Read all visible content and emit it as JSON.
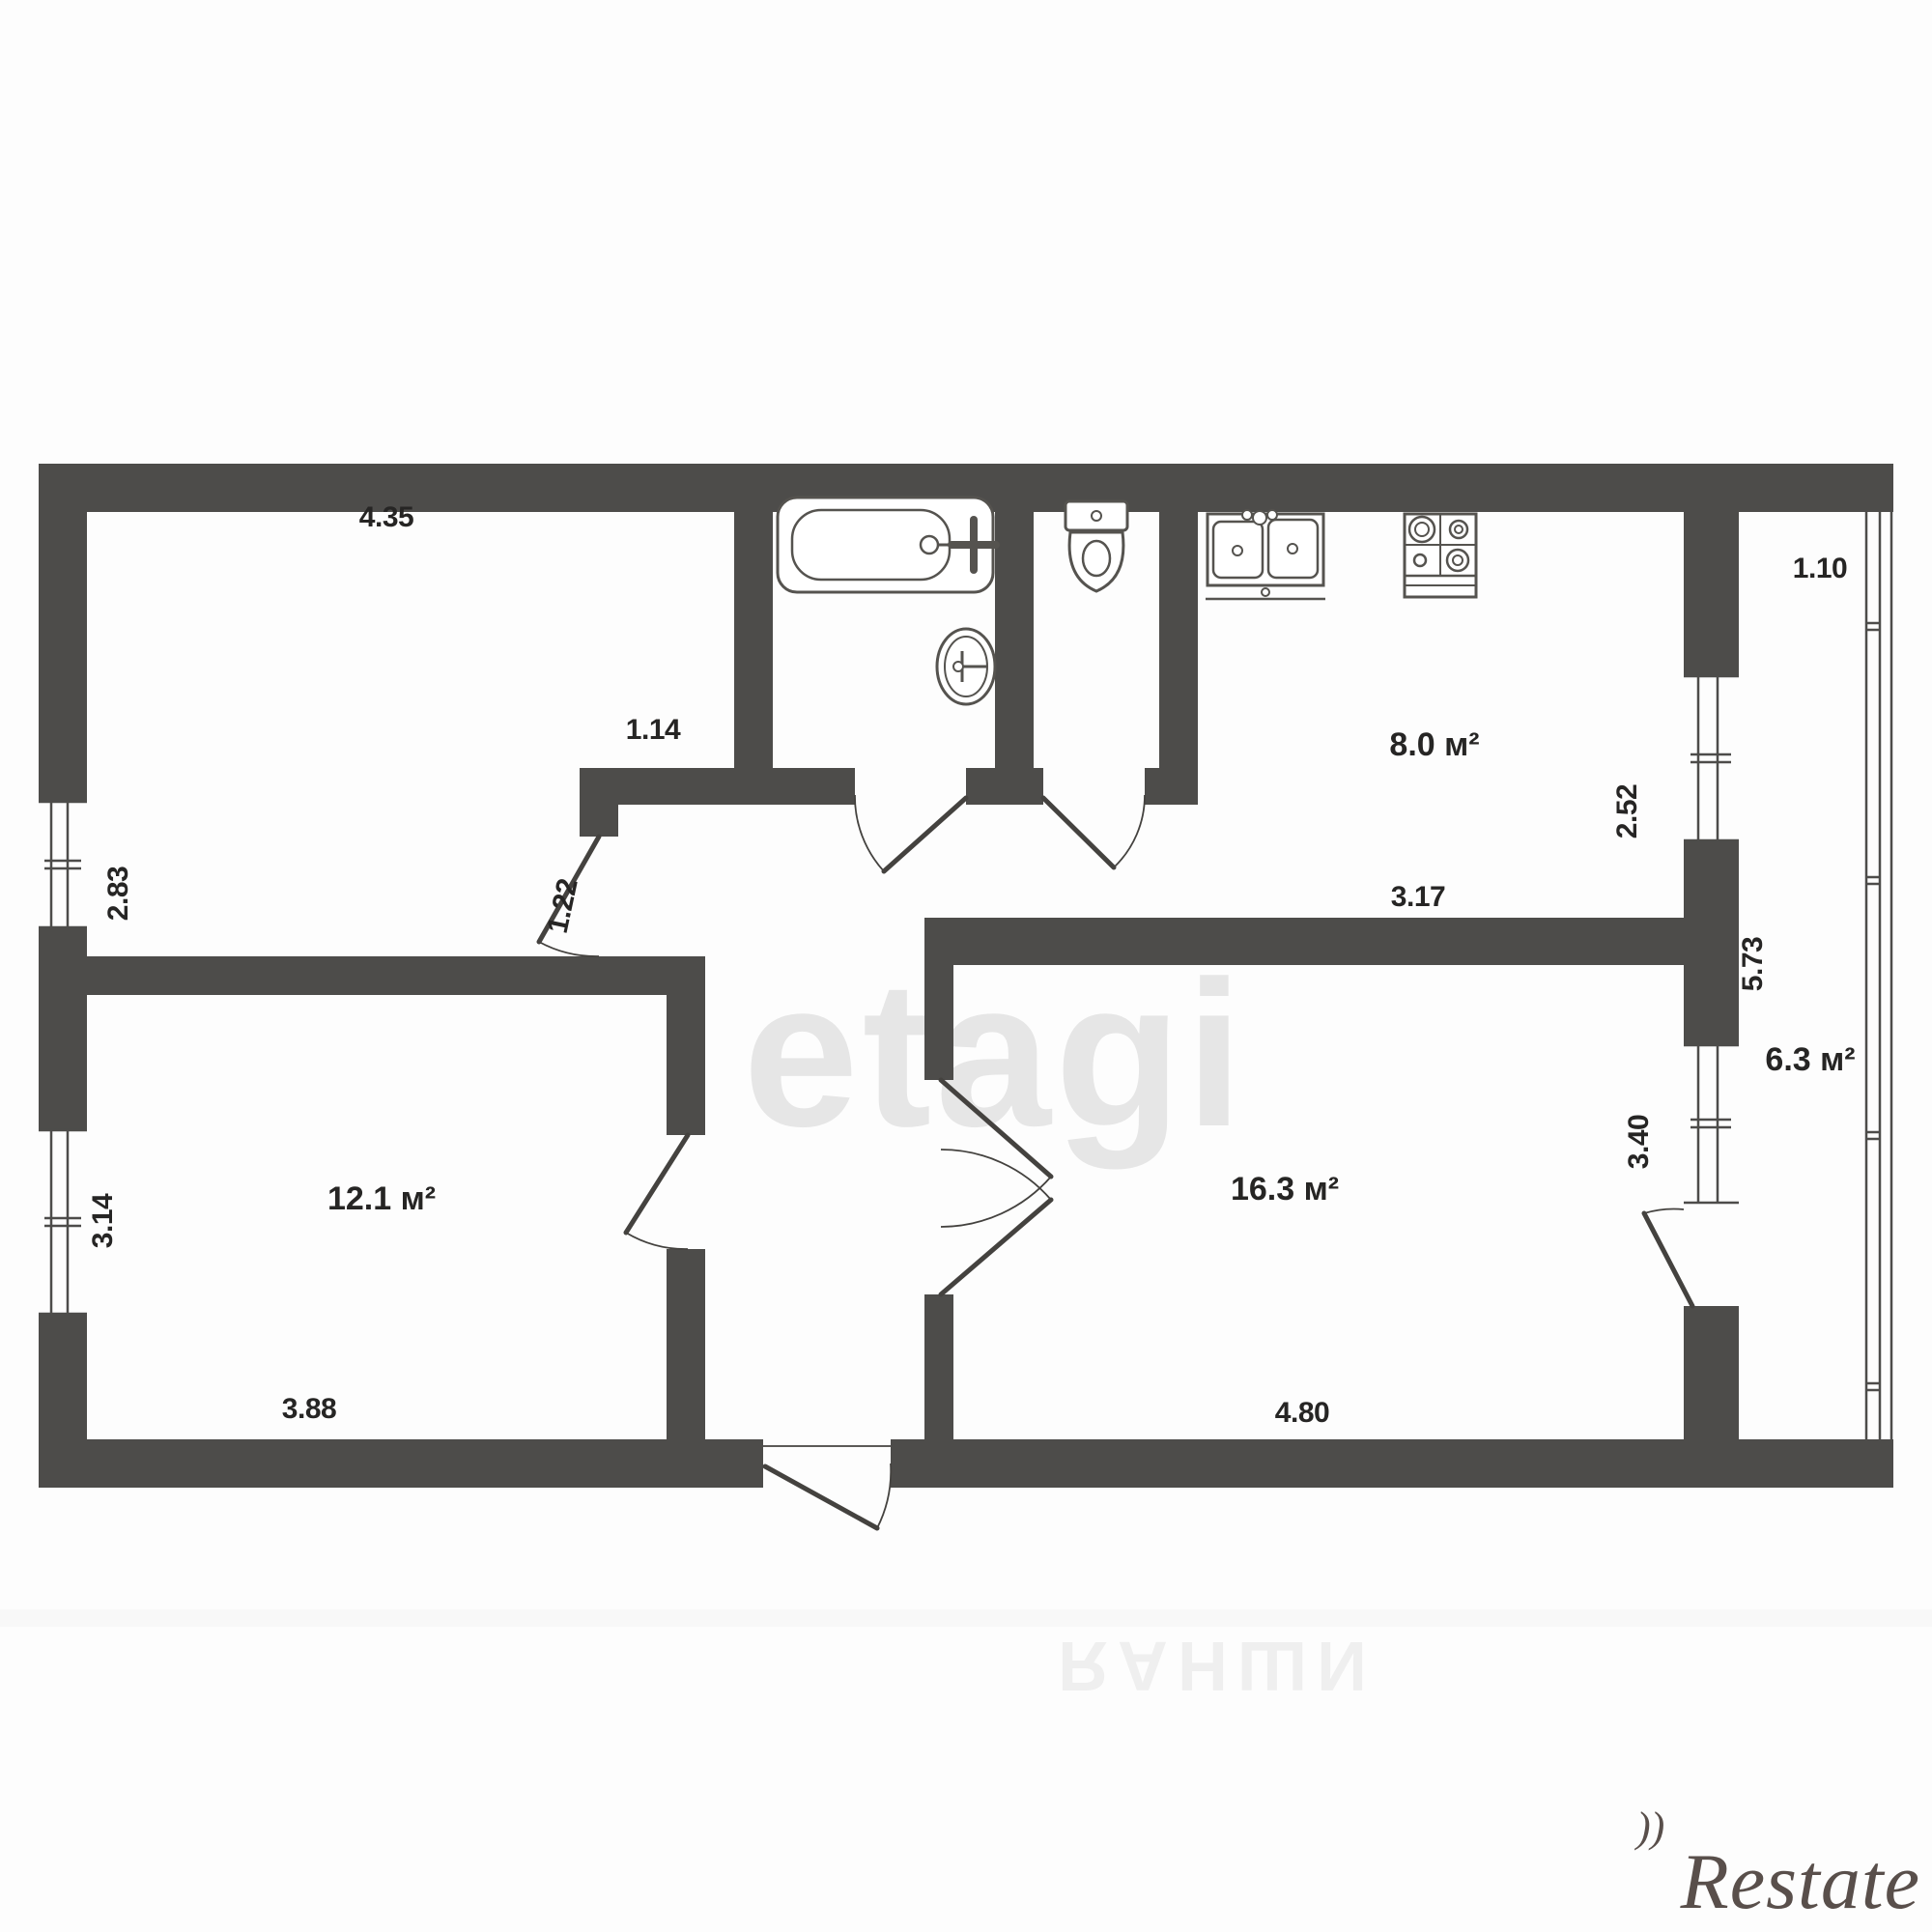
{
  "rooms": {
    "top_left_room": {
      "width": "4.35",
      "height": "2.83",
      "door_width": "1.22"
    },
    "hall_nook": {
      "width": "1.14"
    },
    "kitchen": {
      "area": "8.0 м²",
      "depth": "2.52",
      "width": "3.17"
    },
    "balcony": {
      "area": "6.3 м²",
      "width": "1.10",
      "length": "5.73"
    },
    "living_room": {
      "area": "16.3 м²",
      "width": "4.80",
      "height": "3.40"
    },
    "bottom_left_room": {
      "area": "12.1 м²",
      "width": "3.88",
      "height": "3.14"
    }
  },
  "fixtures": {
    "bathroom": [
      "bathtub",
      "wash-basin"
    ],
    "wc": [
      "toilet"
    ],
    "kitchen": [
      "double-sink",
      "stove"
    ]
  },
  "watermarks": {
    "center": "etagi",
    "bottom": "ИШНАЯ",
    "brand": "Restate",
    "brand_flourish": "))"
  },
  "colors": {
    "wall": "#4d4c4a",
    "fixture_line": "#55534f",
    "label": "#262524",
    "background": "#fdfdfd"
  }
}
